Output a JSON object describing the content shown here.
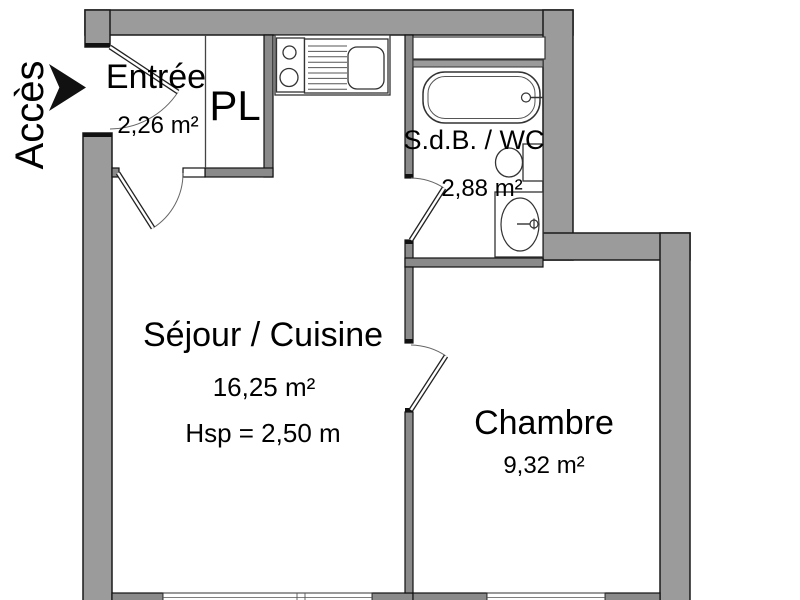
{
  "plan": {
    "access": {
      "label": "Accès"
    },
    "rooms": {
      "entree": {
        "name": "Entrée",
        "area": "2,26 m²"
      },
      "closet": {
        "name": "PL"
      },
      "bathroom": {
        "name": "S.d.B. / WC",
        "area": "2,88 m²"
      },
      "living": {
        "name": "Séjour / Cuisine",
        "area": "16,25 m²",
        "ceiling_height": "Hsp = 2,50 m"
      },
      "bedroom": {
        "name": "Chambre",
        "area": "9,32 m²"
      }
    },
    "colors": {
      "wall_exterior": "#9b9b9b",
      "wall_interior": "#8a8a8a",
      "outline": "#1a1a1a",
      "text": "#000000",
      "background": "#ffffff"
    }
  }
}
